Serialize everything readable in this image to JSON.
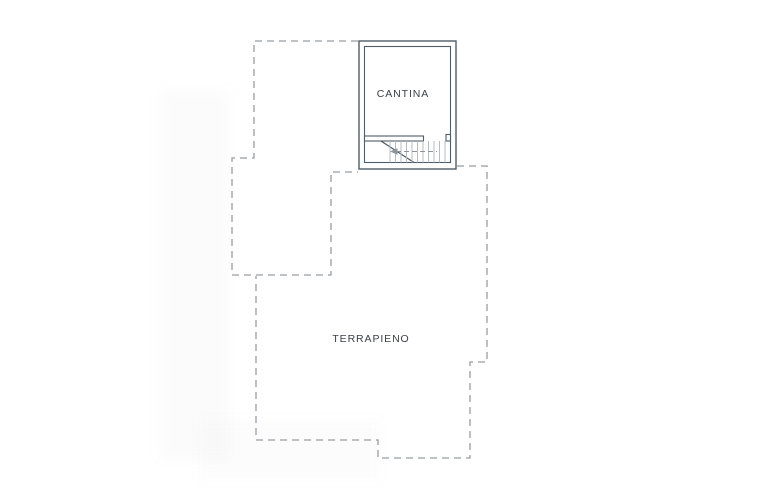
{
  "plan": {
    "labels": {
      "cantina": "CANTINA",
      "terrapieno": "TERRAPIENO"
    },
    "colors": {
      "wall": "#505c66",
      "dashed": "#989da2",
      "tread": "#b7bcc1",
      "arrow": "#8e9499",
      "text": "#3c4147"
    }
  }
}
